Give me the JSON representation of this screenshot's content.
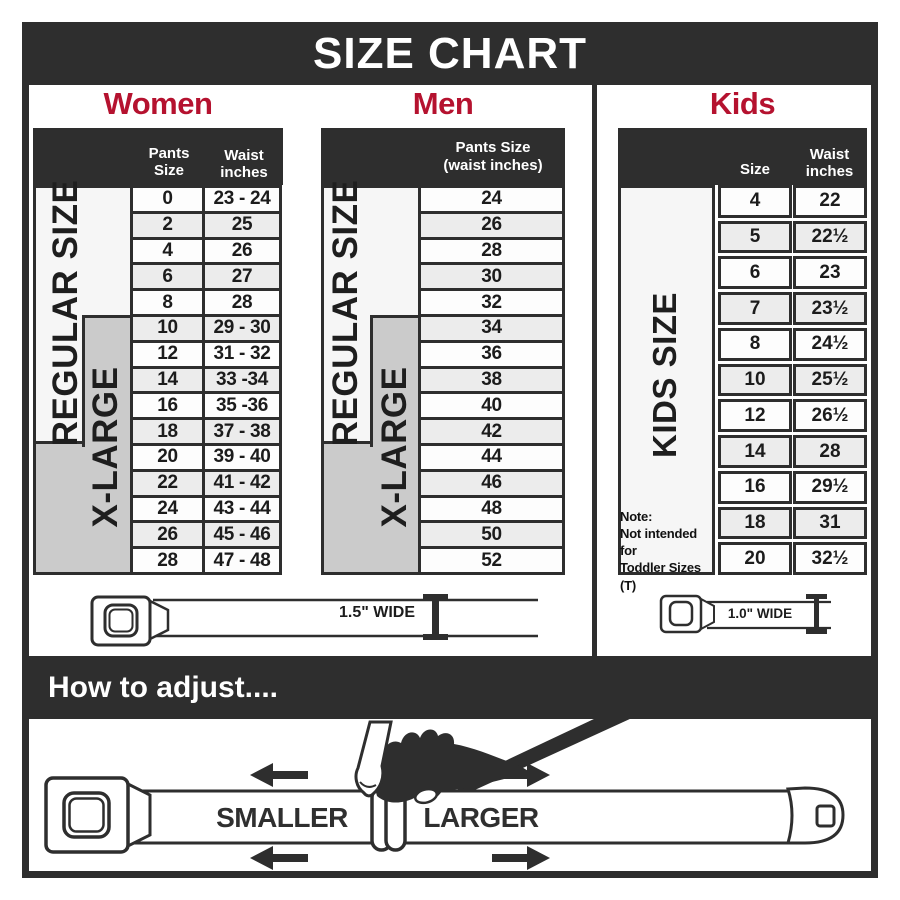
{
  "title": "SIZE CHART",
  "colors": {
    "accent_red": "#b5122f",
    "dark": "#2e2e2e",
    "xlarge_gray": "#cbcbcb",
    "row_alt": "#ececec"
  },
  "women": {
    "heading": "Women",
    "size_col_header": "Pants Size",
    "waist_col_header_line1": "Waist",
    "waist_col_header_line2": "inches",
    "regular_label": "REGULAR SIZE",
    "xlarge_label": "X-LARGE",
    "rows": [
      {
        "size": "0",
        "waist": "23 - 24"
      },
      {
        "size": "2",
        "waist": "25"
      },
      {
        "size": "4",
        "waist": "26"
      },
      {
        "size": "6",
        "waist": "27"
      },
      {
        "size": "8",
        "waist": "28"
      },
      {
        "size": "10",
        "waist": "29 - 30"
      },
      {
        "size": "12",
        "waist": "31 - 32"
      },
      {
        "size": "14",
        "waist": "33 -34"
      },
      {
        "size": "16",
        "waist": "35 -36"
      },
      {
        "size": "18",
        "waist": "37 - 38"
      },
      {
        "size": "20",
        "waist": "39 - 40"
      },
      {
        "size": "22",
        "waist": "41 - 42"
      },
      {
        "size": "24",
        "waist": "43 - 44"
      },
      {
        "size": "26",
        "waist": "45 - 46"
      },
      {
        "size": "28",
        "waist": "47 - 48"
      }
    ]
  },
  "men": {
    "heading": "Men",
    "col_header_line1": "Pants Size",
    "col_header_line2": "(waist inches)",
    "regular_label": "REGULAR SIZE",
    "xlarge_label": "X-LARGE",
    "rows": [
      "24",
      "26",
      "28",
      "30",
      "32",
      "34",
      "36",
      "38",
      "40",
      "42",
      "44",
      "46",
      "48",
      "50",
      "52"
    ]
  },
  "kids": {
    "heading": "Kids",
    "size_col_header": "Size",
    "waist_col_header_line1": "Waist",
    "waist_col_header_line2": "inches",
    "side_label": "KIDS SIZE",
    "note": {
      "line1": "Note:",
      "line2": "Not intended for",
      "line3": "Toddler Sizes (T)"
    },
    "rows": [
      {
        "size": "4",
        "waist": "22"
      },
      {
        "size": "5",
        "waist": "22½"
      },
      {
        "size": "6",
        "waist": "23"
      },
      {
        "size": "7",
        "waist": "23½"
      },
      {
        "size": "8",
        "waist": "24½"
      },
      {
        "size": "10",
        "waist": "25½"
      },
      {
        "size": "12",
        "waist": "26½"
      },
      {
        "size": "14",
        "waist": "28"
      },
      {
        "size": "16",
        "waist": "29½"
      },
      {
        "size": "18",
        "waist": "31"
      },
      {
        "size": "20",
        "waist": "32½"
      }
    ]
  },
  "belts": {
    "adult_width_label": "1.5\" WIDE",
    "kids_width_label": "1.0\" WIDE"
  },
  "how_to": {
    "heading": "How to adjust....",
    "smaller_label": "SMALLER",
    "larger_label": "LARGER"
  }
}
